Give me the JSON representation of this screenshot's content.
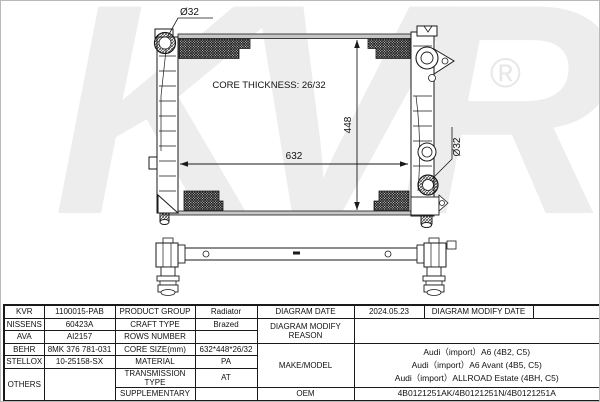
{
  "watermark": {
    "text": "KVR",
    "registered": "®",
    "color": "#ededed"
  },
  "drawing": {
    "labels": {
      "port_top": "Ø32",
      "port_right": "Ø32",
      "core_thickness": "CORE THICKNESS: 26/32",
      "dim_width": "632",
      "dim_height": "448"
    }
  },
  "table": {
    "brands": [
      {
        "name": "KVR",
        "code": "1100015-PAB"
      },
      {
        "name": "NISSENS",
        "code": "60423A"
      },
      {
        "name": "AVA",
        "code": "AI2157"
      },
      {
        "name": "BEHR",
        "code": "8MK 376 781-031"
      },
      {
        "name": "STELLOX",
        "code": "10-25158-SX"
      },
      {
        "name": "OTHERS",
        "code": ""
      }
    ],
    "specs": [
      {
        "label": "PRODUCT GROUP",
        "value": "Radiator"
      },
      {
        "label": "CRAFT TYPE",
        "value": "Brazed"
      },
      {
        "label": "ROWS NUMBER",
        "value": ""
      },
      {
        "label": "CORE SIZE(mm)",
        "value": "632*448*26/32"
      },
      {
        "label": "MATERIAL",
        "value": "PA"
      },
      {
        "label": "TRANSMISSION TYPE",
        "value": "AT"
      },
      {
        "label": "SUPPLEMENTARY",
        "value": ""
      }
    ],
    "diagram": {
      "date_label": "DIAGRAM DATE",
      "date_value": "2024.05.23",
      "modify_date_label": "DIAGRAM MODIFY DATE",
      "modify_date_value": "",
      "modify_reason_label": "DIAGRAM MODIFY REASON",
      "modify_reason_value": "",
      "make_model_label": "MAKE/MODEL",
      "make_model_lines": [
        "Audi（import）A6 (4B2, C5)",
        "Audi（import）A6 Avant (4B5, C5)",
        "Audi（import）ALLROAD Estate (4BH, C5)"
      ],
      "oem_label": "OEM",
      "oem_value": "4B0121251AK/4B0121251N/4B0121251A"
    }
  }
}
